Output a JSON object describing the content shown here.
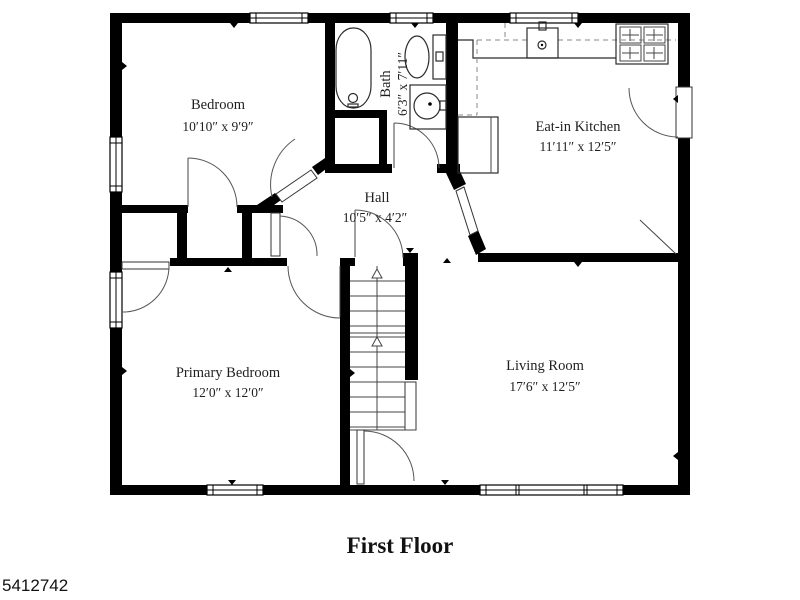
{
  "floorplan": {
    "title": "First Floor",
    "listing_id": "5412742",
    "rooms": [
      {
        "name": "Bedroom",
        "dims": "10′10″ x 9′9″"
      },
      {
        "name": "Bath",
        "dims": "6′3″ x 7′11″"
      },
      {
        "name": "Eat-in Kitchen",
        "dims": "11′11″ x 12′5″"
      },
      {
        "name": "Hall",
        "dims": "10′5″ x 4′2″"
      },
      {
        "name": "Primary Bedroom",
        "dims": "12′0″ x 12′0″"
      },
      {
        "name": "Living Room",
        "dims": "17′6″ x 12′5″"
      }
    ],
    "colors": {
      "wall": "#000000",
      "background": "#ffffff",
      "text": "#1f1f1f"
    }
  }
}
